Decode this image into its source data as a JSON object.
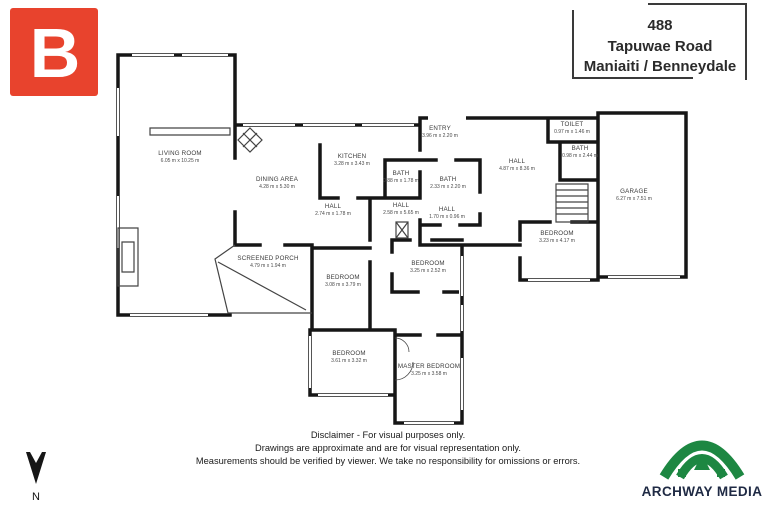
{
  "address": {
    "number": "488",
    "street": "Tapuwae Road",
    "locality": "Maniaiti / Benneydale"
  },
  "branding": {
    "b_logo": {
      "letter": "B",
      "bg_color": "#e8432d",
      "fg_color": "#ffffff"
    },
    "archway": {
      "name": "ARCHWAY MEDIA",
      "symbol_color": "#1d8742",
      "text_color": "#1f2a44"
    }
  },
  "compass": {
    "label": "N"
  },
  "disclaimer": {
    "line1": "Disclaimer - For visual purposes only.",
    "line2": "Drawings are approximate and are for visual representation only.",
    "line3": "Measurements should be verified by viewer. We take no responsibility for omissions or errors."
  },
  "plan": {
    "wall_color": "#161616",
    "window_color": "#555555"
  },
  "rooms": [
    {
      "name": "LIVING ROOM",
      "dims": "6.05 m x 10.25 m"
    },
    {
      "name": "DINING AREA",
      "dims": "4.28 m x 5.30 m"
    },
    {
      "name": "KITCHEN",
      "dims": "3.28 m x 3.43 m"
    },
    {
      "name": "BATH",
      "dims": "0.88 m x 1.78 m"
    },
    {
      "name": "ENTRY",
      "dims": "3.96 m x 2.20 m"
    },
    {
      "name": "TOILET",
      "dims": "0.97 m x 1.46 m"
    },
    {
      "name": "BATH",
      "dims": "0.98 m x 2.44 m"
    },
    {
      "name": "HALL",
      "dims": "4.87 m x 8.36 m"
    },
    {
      "name": "BATH",
      "dims": "2.33 m x 2.20 m"
    },
    {
      "name": "HALL",
      "dims": "2.74 m x 1.78 m"
    },
    {
      "name": "HALL",
      "dims": "2.58 m x 5.65 m"
    },
    {
      "name": "HALL",
      "dims": "1.70 m x 0.96 m"
    },
    {
      "name": "GARAGE",
      "dims": "6.27 m x 7.51 m"
    },
    {
      "name": "BEDROOM",
      "dims": "3.23 m x 4.17 m"
    },
    {
      "name": "SCREENED PORCH",
      "dims": "4.79 m x 1.94 m"
    },
    {
      "name": "BEDROOM",
      "dims": "3.08 m x 3.79 m"
    },
    {
      "name": "BEDROOM",
      "dims": "3.25 m x 2.52 m"
    },
    {
      "name": "BEDROOM",
      "dims": "3.61 m x 3.32 m"
    },
    {
      "name": "MASTER BEDROOM",
      "dims": "3.25 m x 3.58 m"
    }
  ]
}
